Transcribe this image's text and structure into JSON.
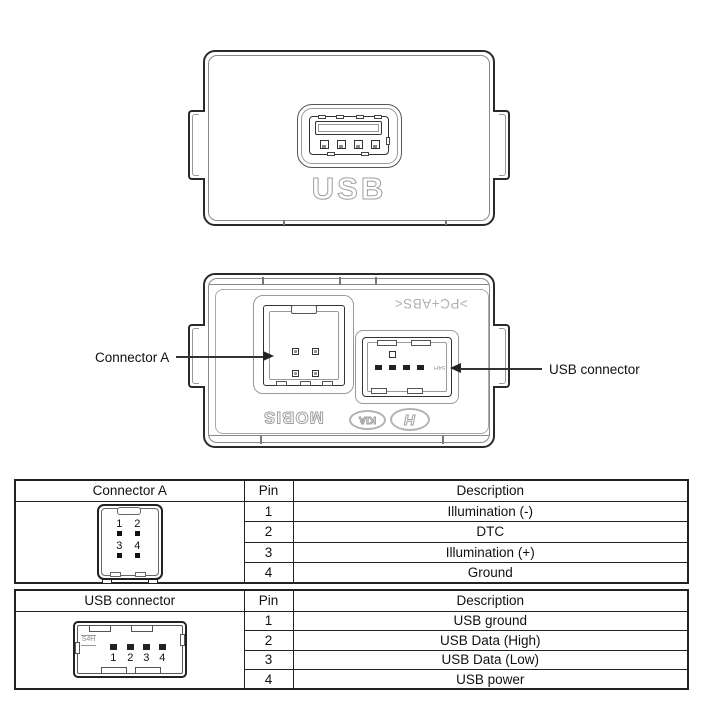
{
  "colors": {
    "line_dark": "#222222",
    "line_mid": "#555555",
    "line_light": "#999999",
    "marking_gray": "#b0b0b0",
    "background": "#ffffff"
  },
  "diagram": {
    "front_view": {
      "port_label": "USB"
    },
    "back_view": {
      "material_marking": ">PC+ABS<",
      "brand_mobis": "MOBIS",
      "brand_kia": "KIA",
      "brand_hyundai_letter": "H",
      "vendor_mark": "S4H",
      "label_connector_a": "Connector A",
      "label_usb_connector": "USB connector"
    }
  },
  "tables": [
    {
      "title": "Connector A",
      "col_pin": "Pin",
      "col_description": "Description",
      "pin_numbers": [
        "1",
        "2",
        "3",
        "4"
      ],
      "rows": [
        {
          "pin": "1",
          "description": "Illumination (-)"
        },
        {
          "pin": "2",
          "description": "DTC"
        },
        {
          "pin": "3",
          "description": "Illumination (+)"
        },
        {
          "pin": "4",
          "description": "Ground"
        }
      ]
    },
    {
      "title": "USB connector",
      "col_pin": "Pin",
      "col_description": "Description",
      "vendor_mark": "S4H",
      "pin_numbers": [
        "1",
        "2",
        "3",
        "4"
      ],
      "rows": [
        {
          "pin": "1",
          "description": "USB ground"
        },
        {
          "pin": "2",
          "description": "USB Data (High)"
        },
        {
          "pin": "3",
          "description": "USB Data (Low)"
        },
        {
          "pin": "4",
          "description": "USB power"
        }
      ]
    }
  ]
}
